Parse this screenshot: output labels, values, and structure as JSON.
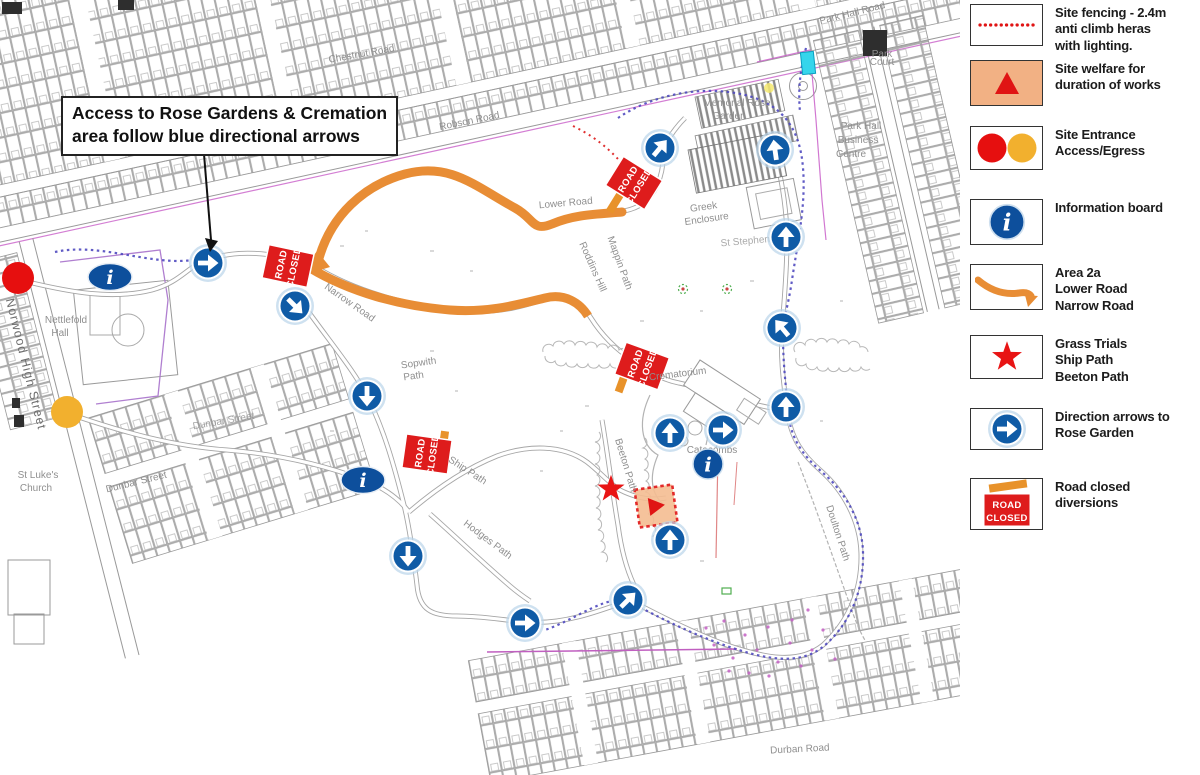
{
  "annotation": {
    "line1": "Access to Rose Gardens & Cremation",
    "line2": "area follow blue directional arrows"
  },
  "road_closed": {
    "line1": "ROAD",
    "line2": "CLOSED"
  },
  "icons": {
    "info_glyph": "i"
  },
  "colors": {
    "arrow_blue": "#0f5ba6",
    "info_blue": "#0d4f9c",
    "closed_red": "#de1c1c",
    "bar_orange": "#e8922a",
    "route_orange": "#e88d35",
    "entrance_red": "#e60f0f",
    "entrance_yellow": "#f2b02e",
    "welfare_peach": "#f2b184",
    "fence_dot_red": "#e01414",
    "cyan_marker": "#35d5ec",
    "boundary_magenta": "#c95fc9"
  },
  "legend": {
    "fencing": {
      "l1": "Site fencing - 2.4m",
      "l2": "anti climb heras",
      "l3": "with lighting."
    },
    "welfare": {
      "l1": "Site welfare for",
      "l2": "duration of works"
    },
    "entrance": {
      "l1": "Site Entrance",
      "l2": "Access/Egress"
    },
    "info": {
      "l1": "Information board"
    },
    "area2a": {
      "l1": "Area 2a",
      "l2": "Lower Road",
      "l3": "Narrow Road"
    },
    "grass": {
      "l1": "Grass Trials",
      "l2": "Ship Path",
      "l3": "Beeton Path"
    },
    "arrows": {
      "l1": "Direction arrows to",
      "l2": "Rose Garden"
    },
    "roadclosed": {
      "l1": "Road closed",
      "l2": "diversions"
    }
  },
  "map_labels": {
    "chestnut": "Chestnut Road",
    "robson": "Robson Road",
    "park_hall_road": "Park Hall Road",
    "norwood": "Norwood High Street",
    "dunbar_a": "Dunbar Street",
    "dunbar_b": "Dunbar Street",
    "lower": "Lower Road",
    "narrow": "Narrow Road",
    "sopwith_1": "Sopwith",
    "sopwith_2": "Path",
    "roddins": "Roddins Hill",
    "mappin": "Mappin Path",
    "ship": "Ship Path",
    "hodges": "Hodges Path",
    "beeton": "Beeton Path",
    "doulton": "Doulton Path",
    "durban": "Durban Road",
    "nettlefold_1": "Nettlefold",
    "nettlefold_2": "Hall",
    "stlukes_1": "St Luke's",
    "stlukes_2": "Church",
    "memorial_1": "Memorial Rose",
    "memorial_2": "Garden",
    "greek_1": "Greek",
    "greek_2": "Enclosure",
    "ststephens": "St Stephens",
    "crematorium": "Crematorium",
    "catacombs": "Catacombs",
    "business_1": "Park Hall",
    "business_2": "Business",
    "business_3": "Centre",
    "park_court_1": "Park",
    "park_court_2": "Court"
  }
}
